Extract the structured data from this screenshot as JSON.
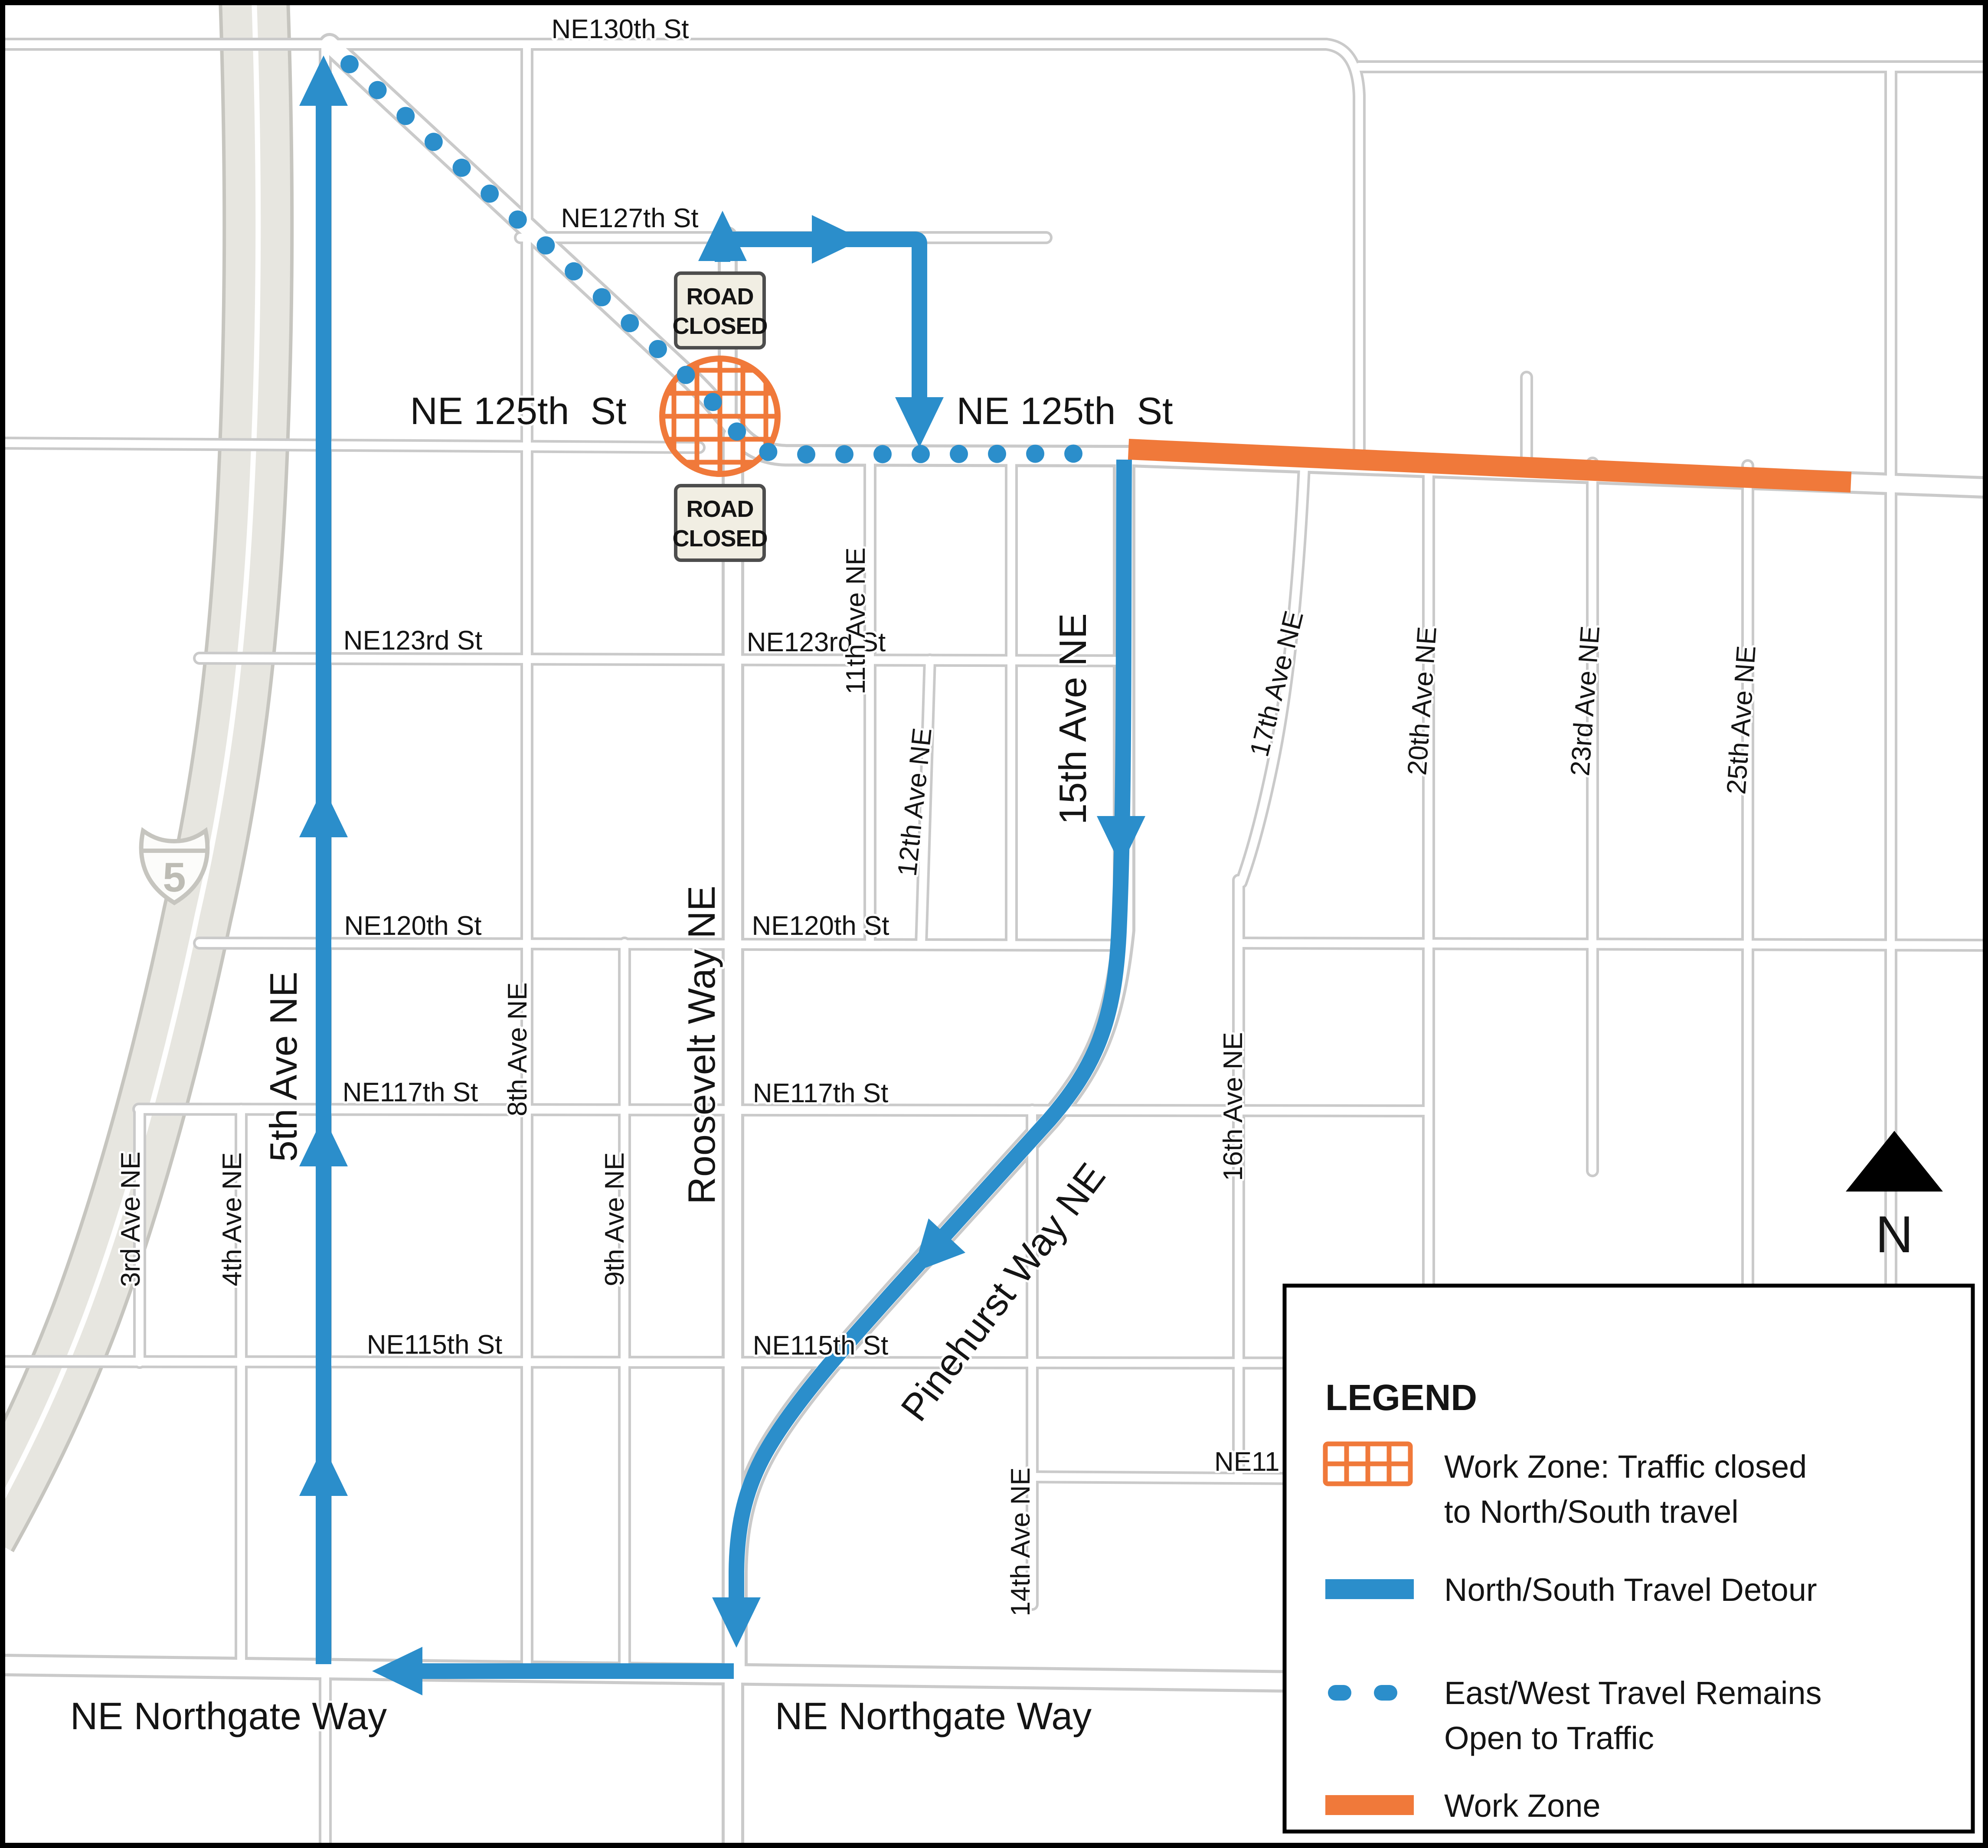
{
  "colors": {
    "detour_blue": "#2b8ecb",
    "work_orange": "#f0793a",
    "road_casing": "#cacaca",
    "road_fill": "#ffffff",
    "freeway_fill": "#e7e6e0",
    "freeway_casing": "#c6c5bf",
    "label_ink": "#141414",
    "sign_fill": "#f1eee3",
    "sign_border": "#4d4d4d",
    "legend_bg": "#ffffff",
    "legend_border": "#000000"
  },
  "interstate_shield": {
    "number": "5"
  },
  "north_arrow": {
    "label": "N"
  },
  "road_closed_sign": {
    "line1": "ROAD",
    "line2": "CLOSED"
  },
  "street_labels": {
    "ne130th": "NE130th St",
    "ne127th": "NE127th St",
    "ne125th_w": "NE 125th  St",
    "ne125th_e": "NE 125th  St",
    "ne123rd_w": "NE123rd St",
    "ne123rd_e": "NE123rd St",
    "ne120th_w": "NE120th St",
    "ne120th_e": "NE120th St",
    "ne117th_w": "NE117th St",
    "ne117th_e": "NE117th St",
    "ne115th_w": "NE115th St",
    "ne115th_e": "NE115th St",
    "ne11x_clipped": "NE11",
    "northgate_w": "NE Northgate Way",
    "northgate_e": "NE Northgate Way"
  },
  "avenue_labels": {
    "third": "3rd Ave NE",
    "fourth": "4th Ave NE",
    "fifth": "5th Ave NE",
    "eighth": "8th Ave NE",
    "ninth": "9th Ave NE",
    "roosevelt": "Roosevelt Way NE",
    "eleventh": "11th Ave NE",
    "twelfth": "12th Ave NE",
    "fourteenth": "14th Ave NE",
    "fifteenth": "15th Ave NE",
    "sixteenth": "16th Ave NE",
    "seventeenth": "17th Ave NE",
    "twentieth": "20th Ave NE",
    "twentythird": "23rd Ave NE",
    "twentyfifth": "25th Ave NE",
    "pinehurst": "Pinehurst Way NE"
  },
  "legend": {
    "title": "LEGEND",
    "items": [
      {
        "icon": "work-zone-crosshatch-icon",
        "line1": "Work Zone: Traffic closed",
        "line2": "to North/South travel"
      },
      {
        "icon": "detour-line-icon",
        "line1": "North/South Travel Detour",
        "line2": ""
      },
      {
        "icon": "open-travel-dots-icon",
        "line1": "East/West Travel Remains",
        "line2": "Open to Traffic"
      },
      {
        "icon": "work-zone-line-icon",
        "line1": "Work Zone",
        "line2": ""
      }
    ]
  }
}
